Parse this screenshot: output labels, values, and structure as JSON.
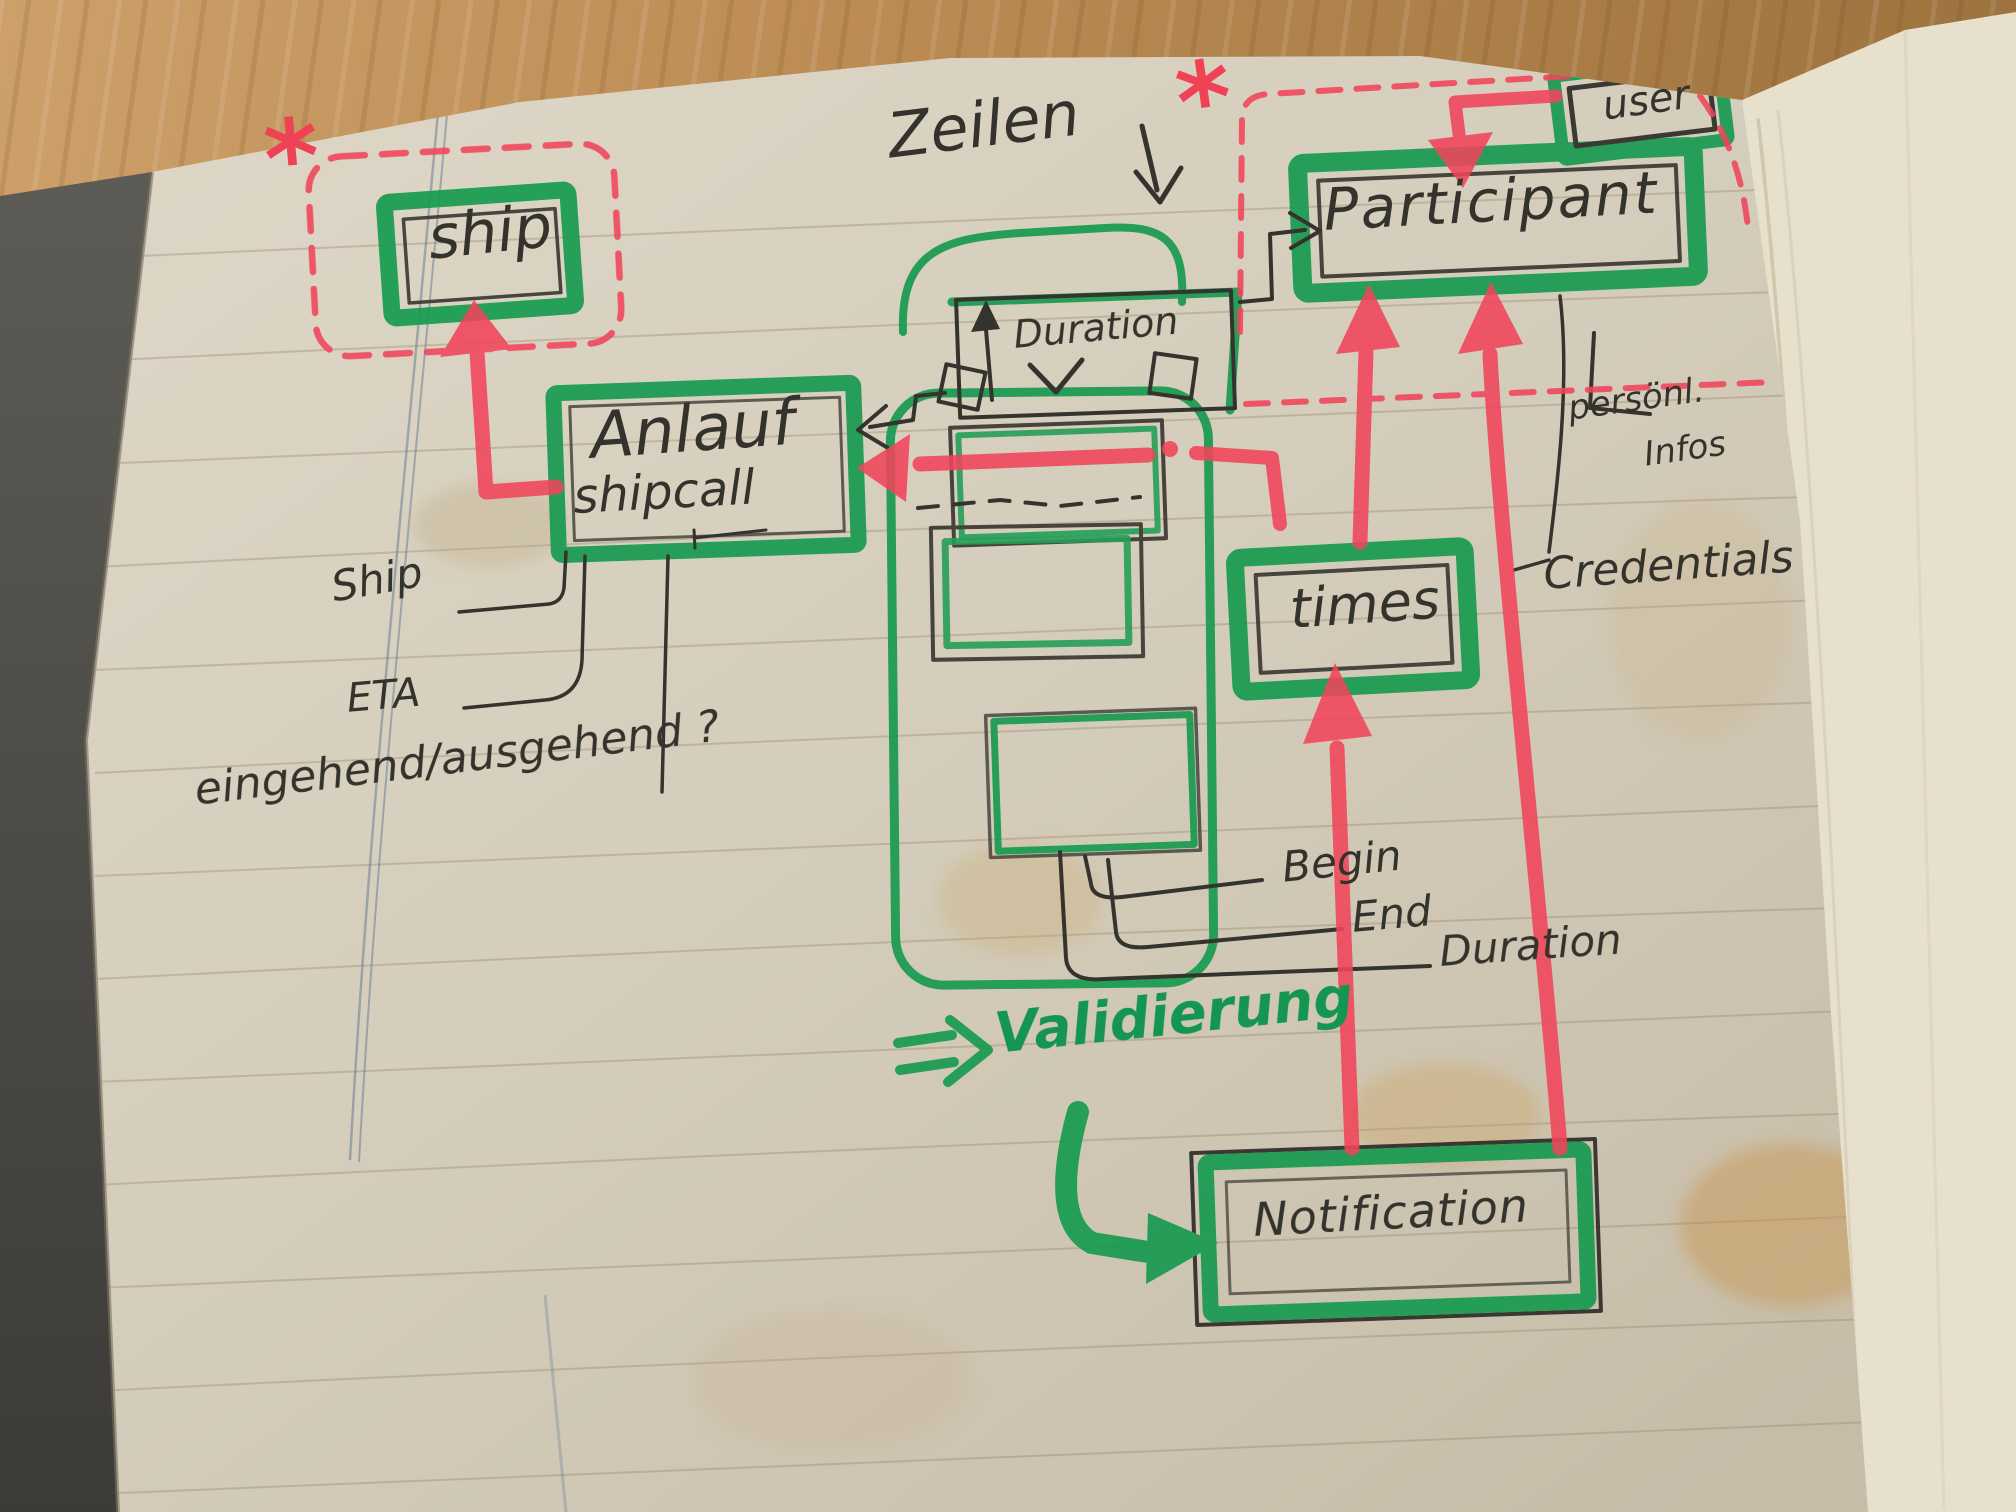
{
  "notebook_diagram": {
    "boxes": {
      "ship": "ship",
      "anlauf": "Anlauf",
      "anlauf_sub": "shipcall",
      "participant": "Participant",
      "user": "user",
      "times": "times",
      "notification": "Notification",
      "duration": "Duration"
    },
    "labels": {
      "zeilen": "Zeilen",
      "ship_attr": "Ship",
      "eta": "ETA",
      "in_out": "eingehend/ausgehend ?",
      "begin": "Begin",
      "end": "End",
      "duration": "Duration",
      "validierung": "Validierung",
      "personal_info_line1": "persönl.",
      "personal_info_line2": "Infos",
      "credentials": "Credentials",
      "asterisk": "*"
    },
    "colors": {
      "marker_green": "#179c52",
      "marker_red": "#f1455b",
      "pen_black": "#35332d"
    }
  }
}
